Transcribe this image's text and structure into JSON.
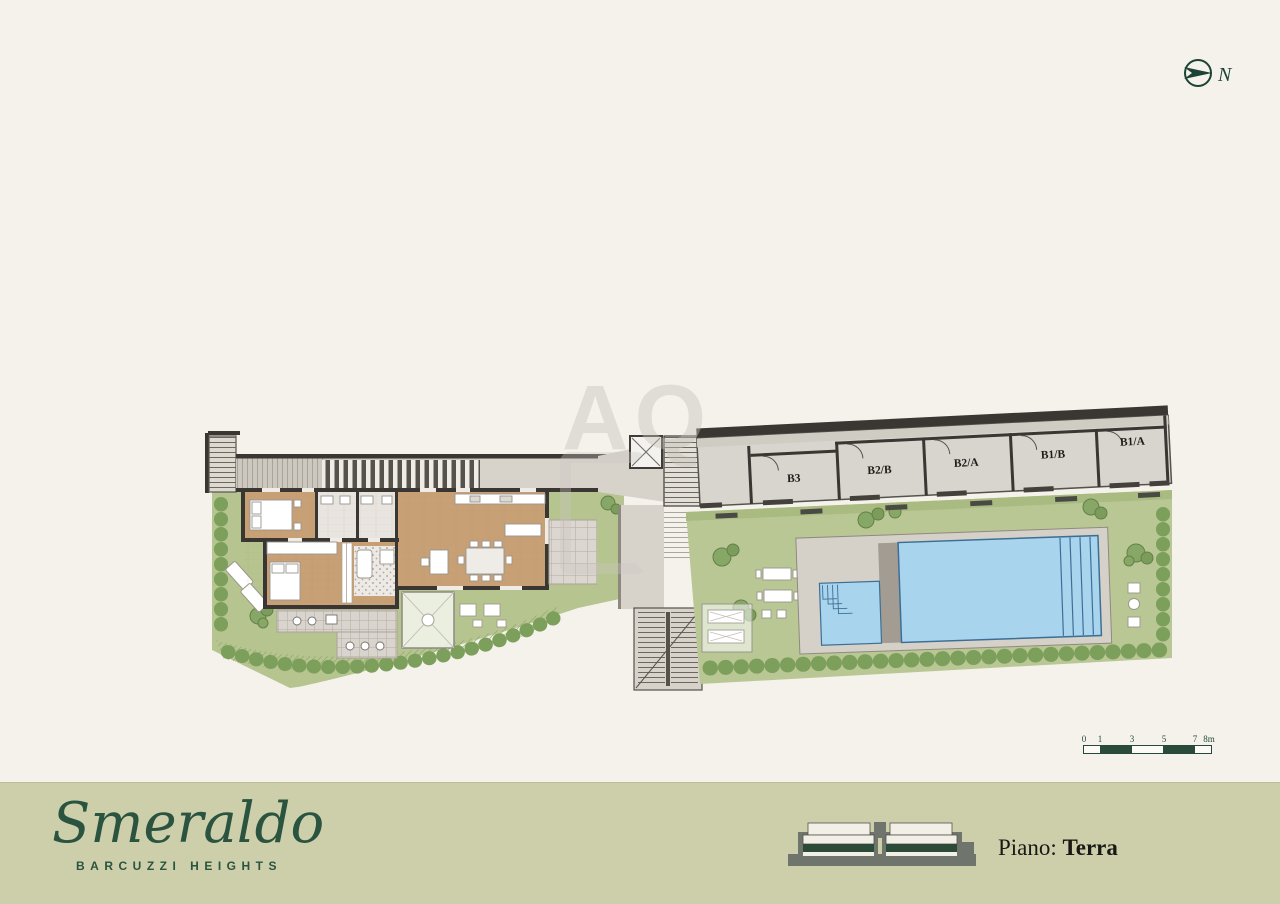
{
  "north": {
    "label": "N"
  },
  "watermark": {
    "text": "AQ"
  },
  "garage": {
    "units": [
      "B3",
      "B2/B",
      "B2/A",
      "B1/B",
      "B1/A"
    ]
  },
  "scalebar": {
    "labels": [
      "0",
      "1",
      "3",
      "5",
      "7",
      "8m"
    ]
  },
  "footer": {
    "brand": "Smeraldo",
    "subtitle": "BARCUZZI HEIGHTS",
    "floor_label": "Piano:",
    "floor_value": "Terra"
  },
  "colors": {
    "brand_green": "#2a5340",
    "band": "#cdcfab",
    "lawn": "#b8c591",
    "pool_blue": "#a9d4ee",
    "wood": "#c7a076",
    "wall": "#3a3733"
  }
}
